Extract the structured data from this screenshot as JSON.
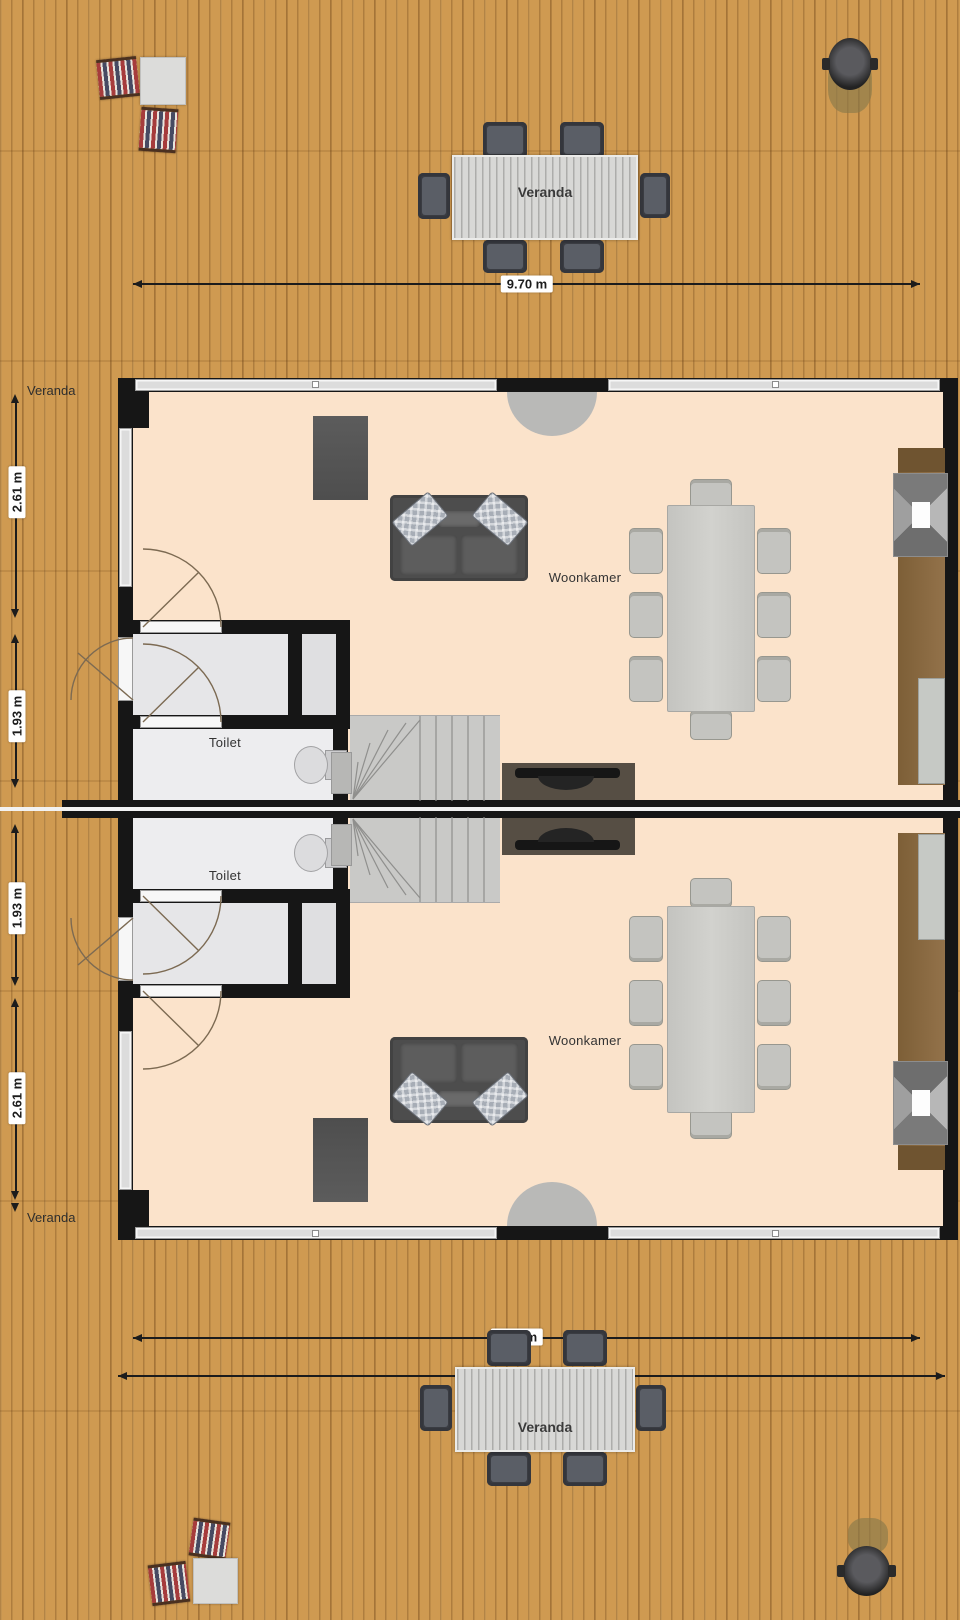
{
  "colors": {
    "deck_wood": "#cf9a51",
    "floor": "#fbe3cb",
    "wall": "#161616",
    "window_glass": "#dcdcdc",
    "hall_floor": "#e6e6e8",
    "toilet_floor": "#ededef",
    "stairs": "#c9c9c7",
    "sofa": "#4d4d4d",
    "counter_wood": "#8a6a3e",
    "desk": "#564e44",
    "dim_line": "#1c1c1c"
  },
  "unit_top": {
    "living_label": "Woonkamer",
    "toilet_label": "Toilet"
  },
  "unit_bottom": {
    "living_label": "Woonkamer",
    "toilet_label": "Toilet"
  },
  "veranda_top": {
    "table_label": "Veranda",
    "width_dim": "9.70 m"
  },
  "veranda_bottom": {
    "table_label": "Veranda",
    "width_dim": "9.70 m",
    "outer_width_dim": "10.00 m"
  },
  "left_dims_top": {
    "area_label": "Veranda",
    "veranda_depth": "2.61 m",
    "hall_depth": "1.93 m"
  },
  "left_dims_bottom": {
    "area_label": "Veranda",
    "veranda_depth": "2.61 m",
    "hall_depth": "1.93 m"
  }
}
